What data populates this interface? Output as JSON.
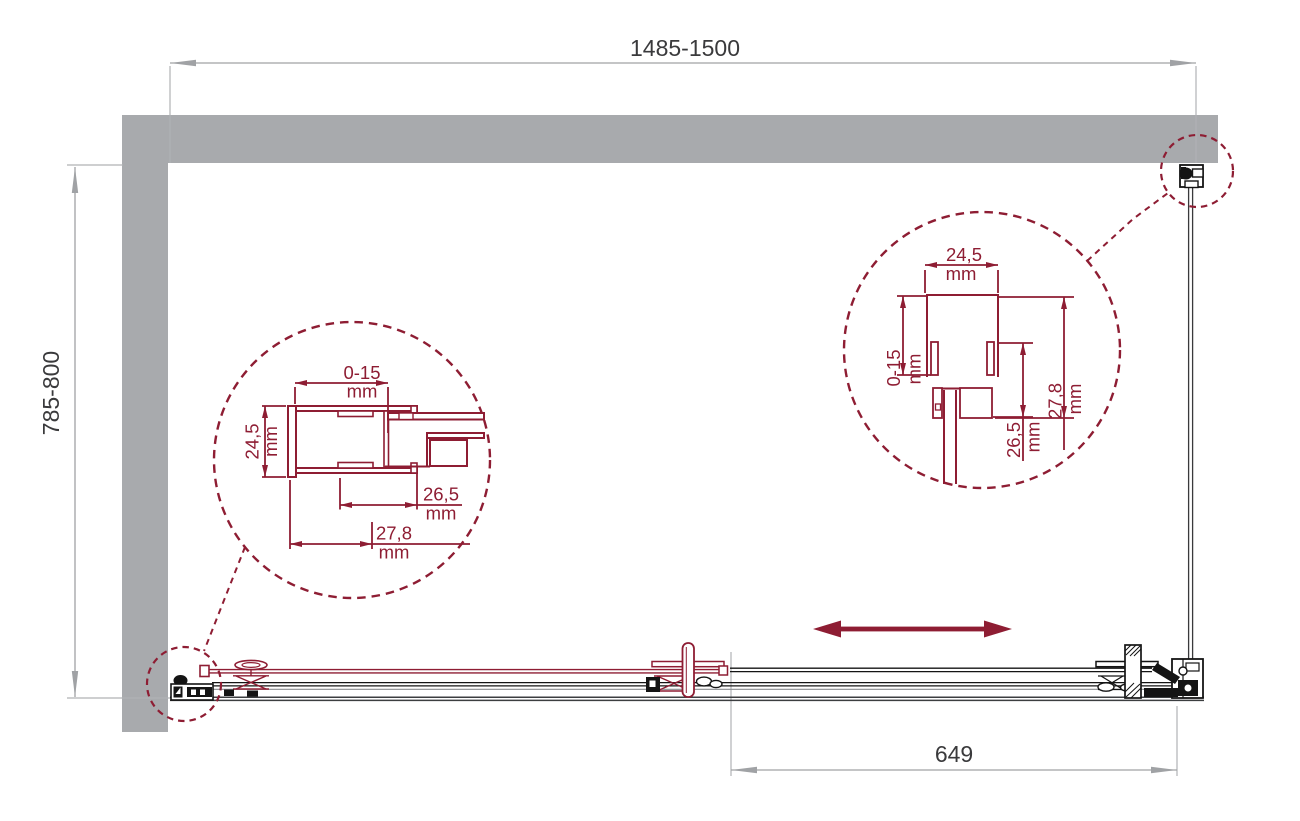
{
  "colors": {
    "accent_red": "#8E1D33",
    "wall_gray": "#A8AAAD",
    "dim_line_gray": "#A0A2A5",
    "dim_text": "#3A3A3C",
    "hardware_black": "#141414"
  },
  "dimensions": {
    "overall_width": {
      "value": "1485-1500"
    },
    "overall_depth": {
      "value": "785-800"
    },
    "door_panel_width": {
      "value": "649"
    }
  },
  "detail_left": {
    "adjustment": {
      "value": "0-15",
      "unit": "mm"
    },
    "profile_height": {
      "value": "24,5",
      "unit": "mm"
    },
    "dim_a": {
      "value": "26,5",
      "unit": "mm"
    },
    "dim_b": {
      "value": "27,8",
      "unit": "mm"
    }
  },
  "detail_right": {
    "profile_width": {
      "value": "24,5",
      "unit": "mm"
    },
    "adjustment": {
      "value": "0-15",
      "unit": "mm"
    },
    "dim_a": {
      "value": "26,5",
      "unit": "mm"
    },
    "dim_b": {
      "value": "27,8",
      "unit": "mm"
    }
  },
  "icons": {
    "slide_arrow": "double-headed-horizontal-arrow"
  }
}
